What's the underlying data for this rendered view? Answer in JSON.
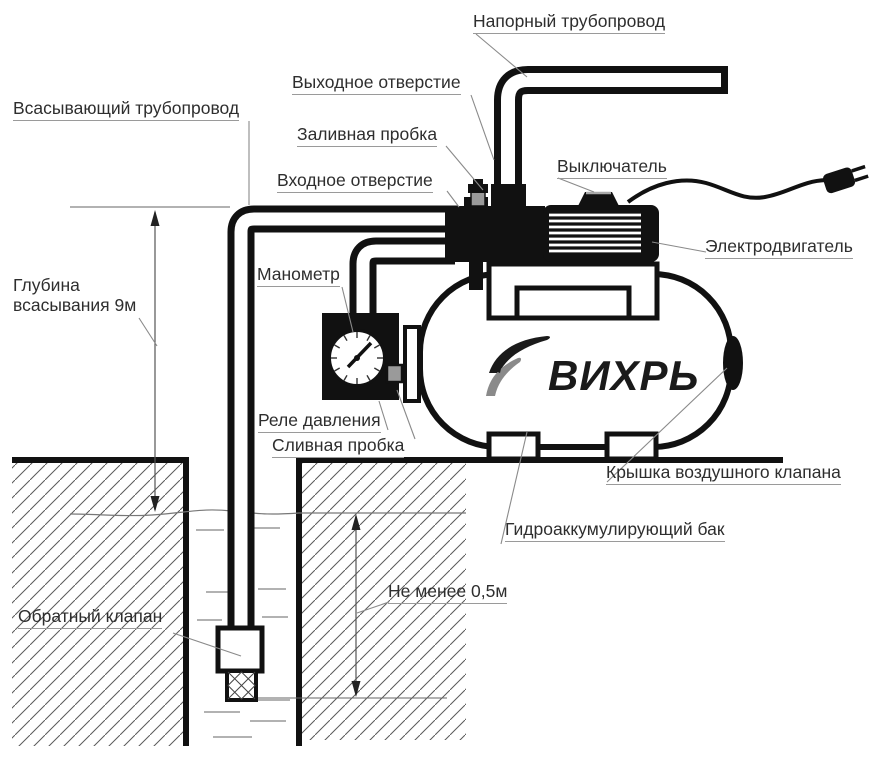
{
  "brand": "ВИХРЬ",
  "labels": {
    "pressure_pipe": "Напорный трубопровод",
    "outlet": "Выходное отверстие",
    "suction_pipe": "Всасывающий трубопровод",
    "filler_plug": "Заливная пробка",
    "inlet": "Входное отверстие",
    "switch": "Выключатель",
    "motor": "Электродвигатель",
    "manometer": "Манометр",
    "pressure_relay": "Реле давления",
    "drain_plug": "Сливная пробка",
    "check_valve": "Обратный клапан",
    "air_valve_cap": "Крышка воздушного клапана",
    "tank": "Гидроаккумулирующий бак"
  },
  "dimensions": {
    "suction_depth_line1": "Глубина",
    "suction_depth_line2": "всасывания 9м",
    "min_water_height": "Не менее 0,5м"
  },
  "colors": {
    "ink": "#1a1a1a",
    "leader": "#8a8a8a",
    "metal_gray": "#9a9a9a"
  }
}
